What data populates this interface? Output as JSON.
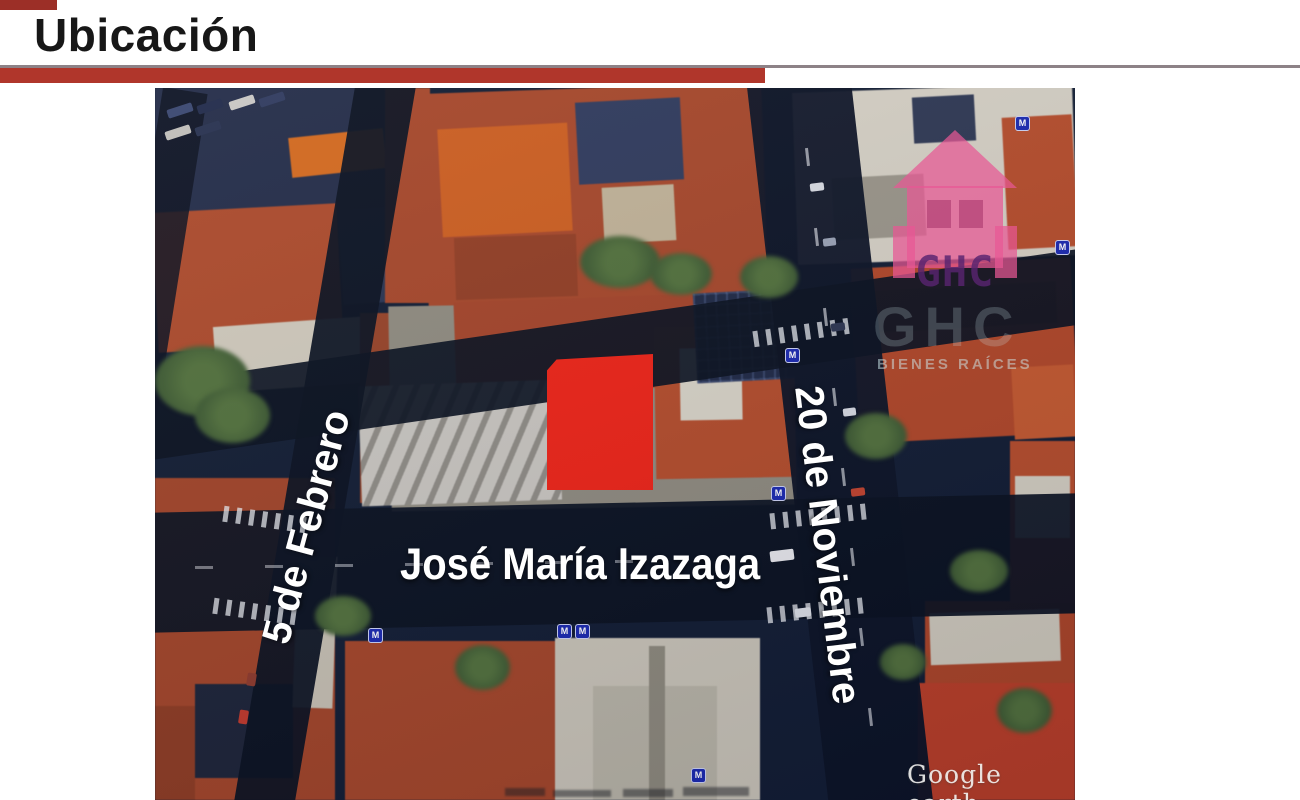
{
  "slide": {
    "title": "Ubicación"
  },
  "map": {
    "street_labels": [
      {
        "name": "5 de Febrero"
      },
      {
        "name": "José María Izazaga"
      },
      {
        "name": "20 de Noviembre"
      }
    ],
    "highlighted_parcel": {
      "color": "#ee2417"
    },
    "watermarks": {
      "google_earth": "Google earth",
      "logo_letters": "GHC",
      "logo_subtext": "BIENES RAÍCES"
    },
    "metro_icon_label": "M"
  },
  "colors": {
    "accent-bar": "#b0362b",
    "corner-chip": "#9c2f27",
    "divider-line": "#8d8287",
    "parcel-red": "#ee2417",
    "logo-pink": "#e75794",
    "logo-purple": "#582470",
    "label-white": "#ffffff",
    "map-base": "#121d33"
  }
}
